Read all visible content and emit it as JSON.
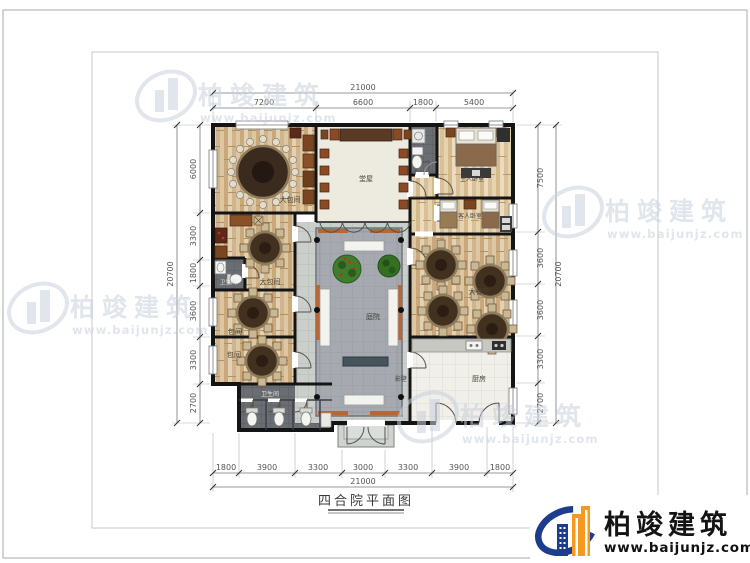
{
  "title": "四合院平面图",
  "brand": {
    "name": "柏竣建筑",
    "url": "www.baijunjz.com"
  },
  "watermark": {
    "name": "柏竣建筑",
    "url": "www.baijunjz.com"
  },
  "dims": {
    "top_total": "21000",
    "bottom_total": "21000",
    "left_total": "20700",
    "right_total": "20700",
    "top": [
      "7200",
      "6600",
      "1800",
      "5400"
    ],
    "bottom": [
      "1800",
      "3900",
      "3300",
      "3000",
      "3300",
      "3900",
      "1800"
    ],
    "left": [
      "6000",
      "3300",
      "1800",
      "3600",
      "3300",
      "2700"
    ],
    "right": [
      "7500",
      "3600",
      "3600",
      "3300",
      "2700"
    ]
  },
  "rooms": {
    "banquet": "大包间",
    "hall": "堂屋",
    "master_bedroom": "主人卧室",
    "guest_bedroom": "客人卧室",
    "private_large": "大包间",
    "wc_small": "卫生间",
    "private_1": "包间",
    "private_2": "包间",
    "wc_public": "卫生间",
    "dining_hall": "大餐厅",
    "kitchen": "厨房",
    "courtyard": "庭院",
    "screen_wall": "影壁"
  },
  "colors": {
    "wall": "#141414",
    "wood": "#d6bd97",
    "paving": "#cbcfcb",
    "platform": "#a6aab0",
    "planter_orange": "#b5673a",
    "logo_blue": "#1c3c8c",
    "logo_orange": "#f59a1f",
    "watermark_gray": "#c8d0dc",
    "dim_text": "#555555"
  }
}
